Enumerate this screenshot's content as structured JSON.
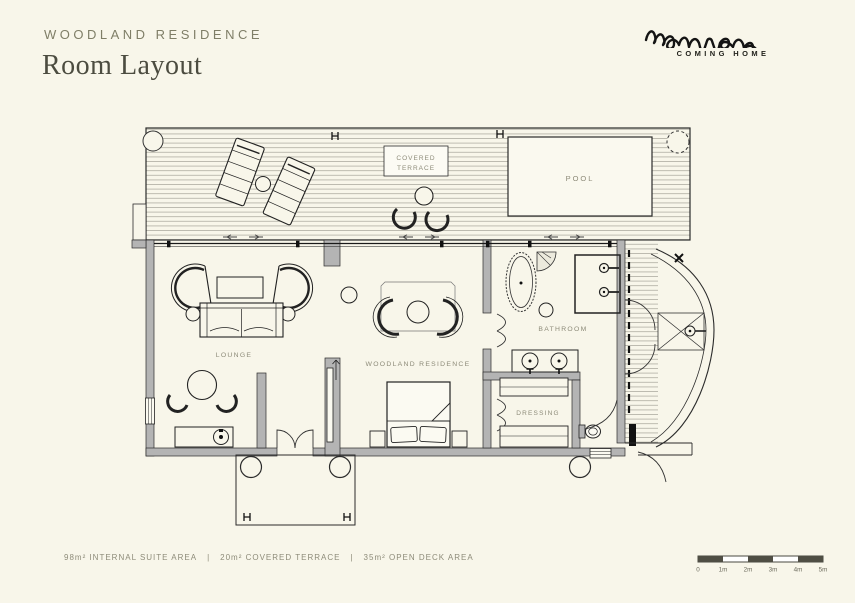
{
  "colors": {
    "background": "#f8f6ea",
    "ink": "#1a1a1a",
    "wall_gray": "#b4b4b4",
    "label_olive": "#8d8b79",
    "title_olive": "#7f7e67",
    "scale_dark": "#4f4e44"
  },
  "header": {
    "kicker": "WOODLAND RESIDENCE",
    "title": "Room Layout"
  },
  "logo": {
    "wordmark": "monwana",
    "tagline": "COMING HOME"
  },
  "plan": {
    "labels": {
      "covered_terrace_1": "COVERED",
      "covered_terrace_2": "TERRACE",
      "pool": "POOL",
      "lounge": "LOUNGE",
      "bedroom": "WOODLAND RESIDENCE",
      "bathroom": "BATHROOM",
      "dressing": "DRESSING"
    }
  },
  "footer": {
    "area_items": [
      "98m² INTERNAL SUITE AREA",
      "20m² COVERED TERRACE",
      "35m² OPEN DECK AREA"
    ],
    "separator": "|"
  },
  "scale_bar": {
    "ticks": [
      "0",
      "1m",
      "2m",
      "3m",
      "4m",
      "5m"
    ]
  }
}
